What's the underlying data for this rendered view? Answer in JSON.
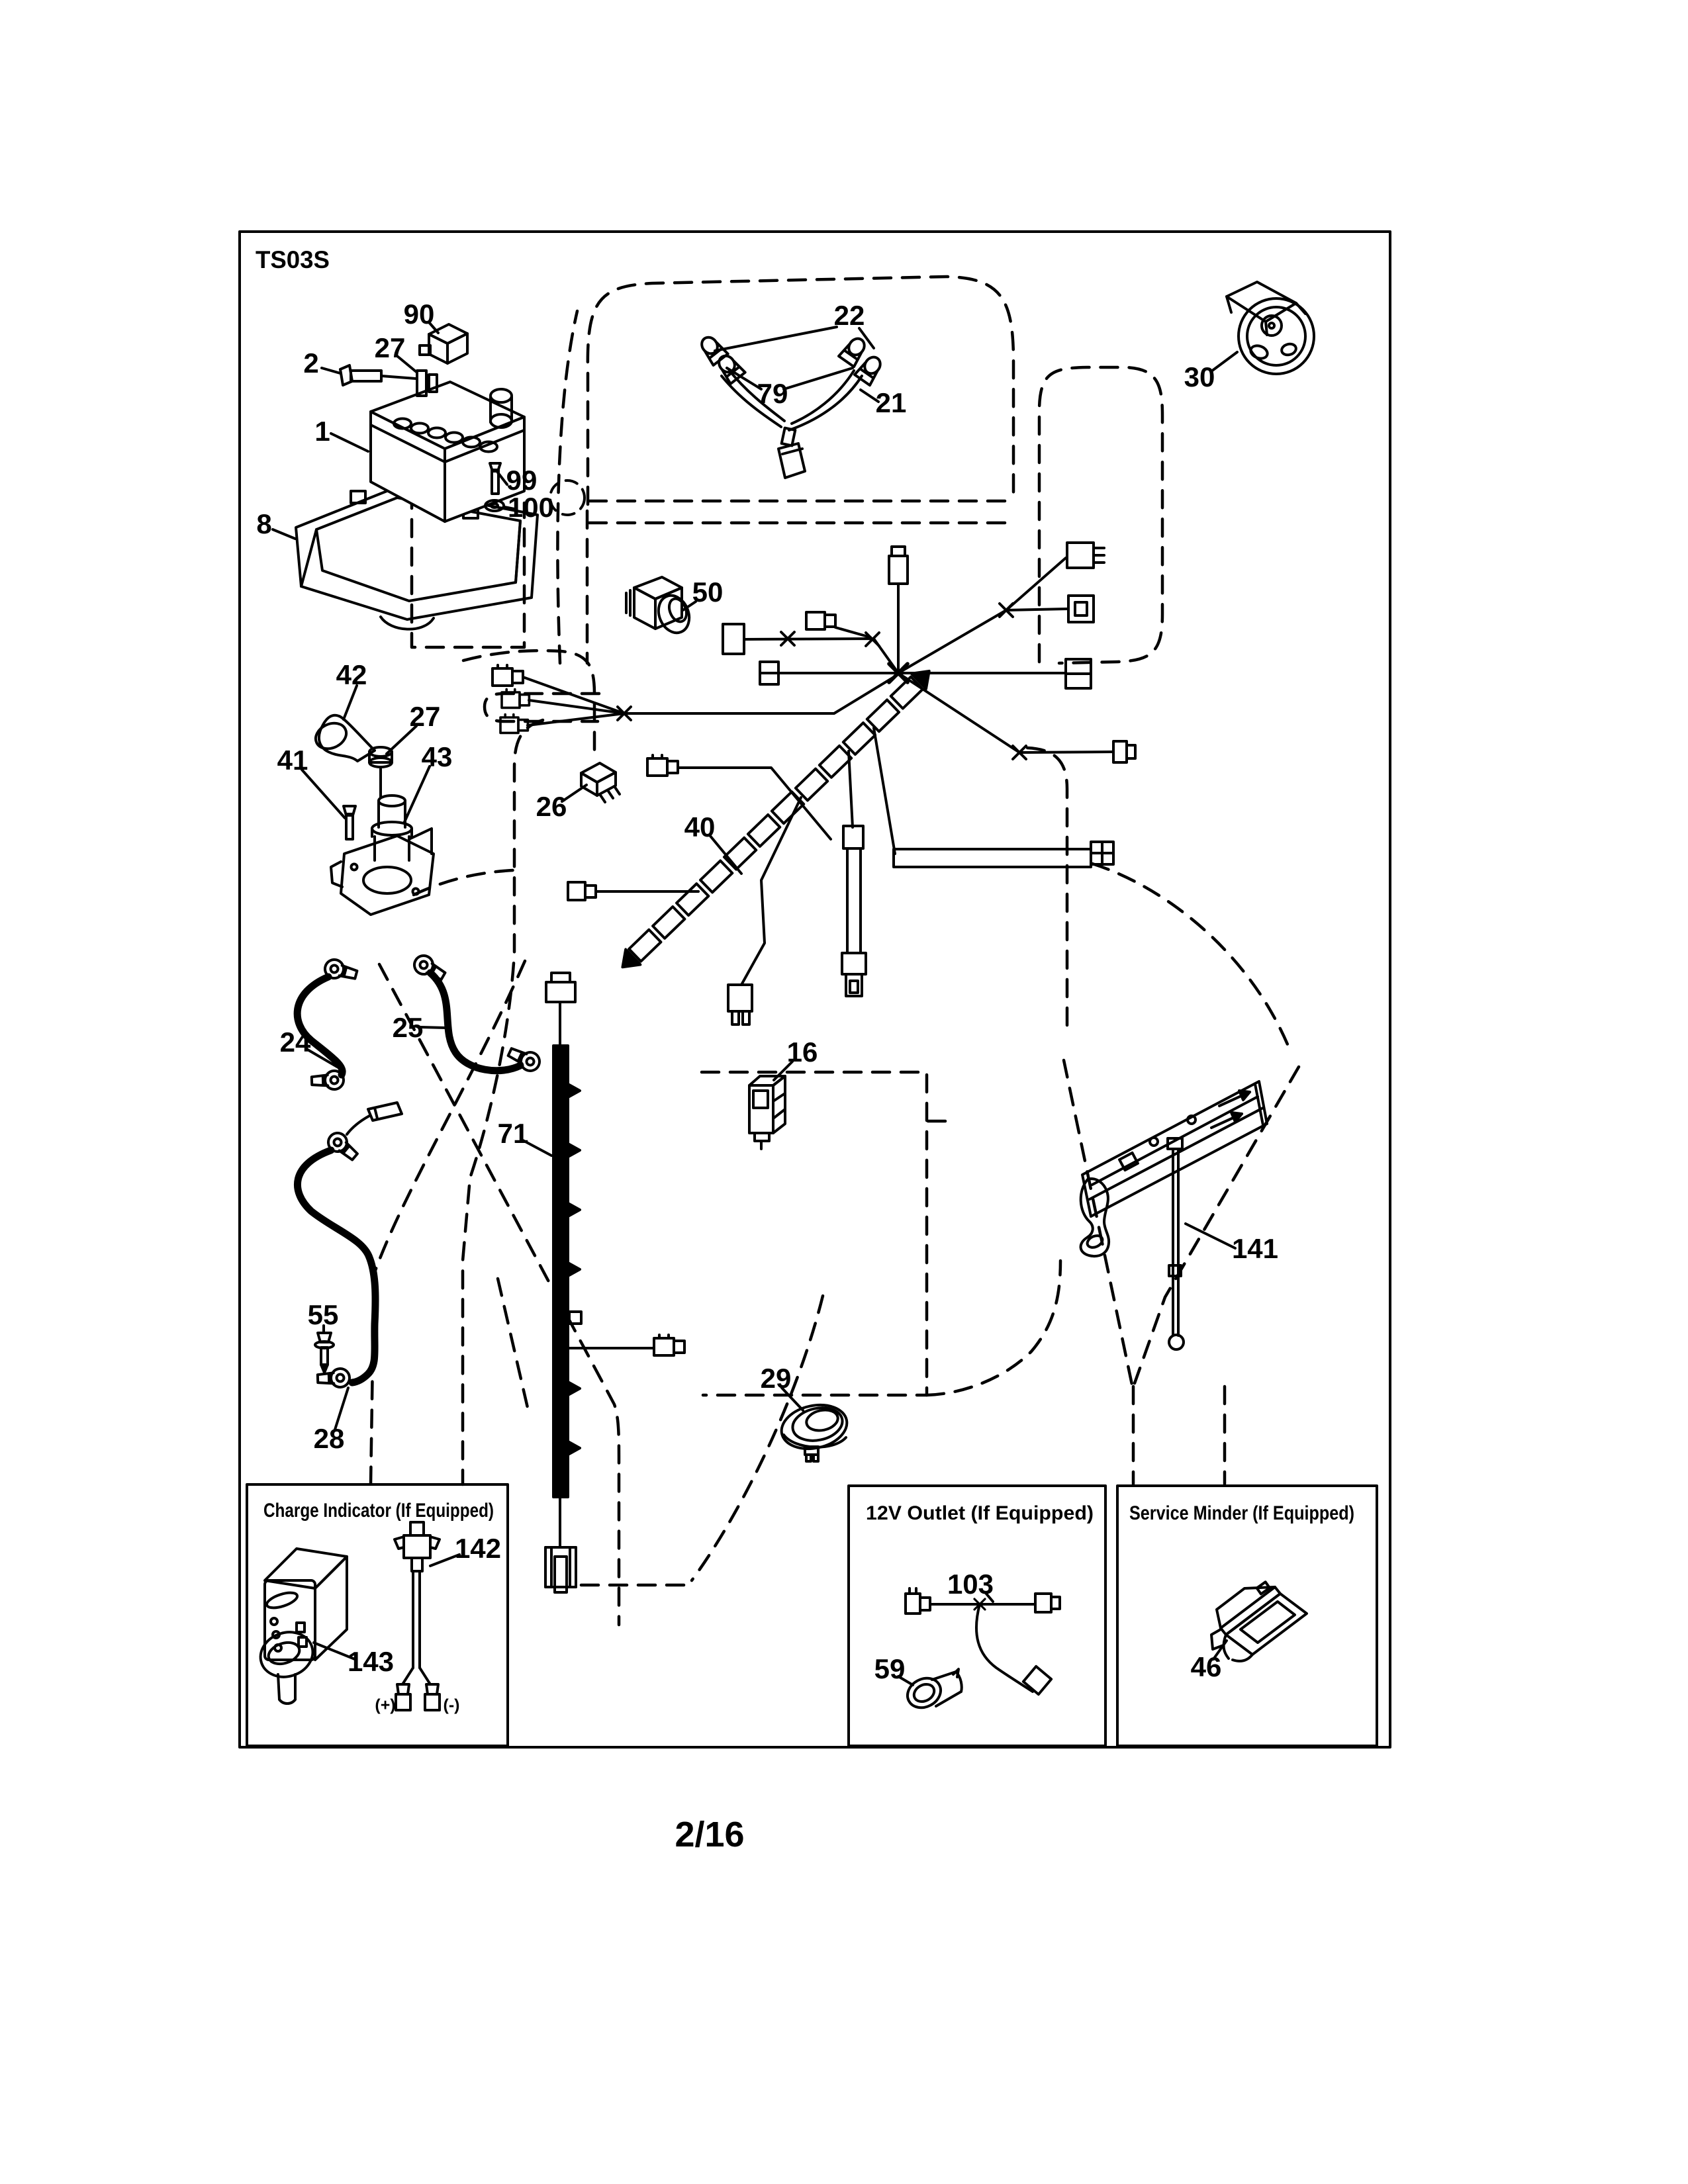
{
  "doc": {
    "sheet_code": "TS03S",
    "page_number": "2/16"
  },
  "callouts": {
    "battery": "1",
    "battery_bolt": "2",
    "battery_tray": "8",
    "interlock_switch": "16",
    "headlight_connector": "21",
    "headlight_bulbs": "22",
    "battery_cable_neg": "24",
    "battery_cable_pos": "25",
    "relay": "26",
    "battery_clamp_nut": "27",
    "solenoid_nut": "27",
    "ground_cable": "28",
    "horn": "29",
    "ignition_switch": "30",
    "main_harness": "40",
    "solenoid_bolt": "41",
    "terminal_boot": "42",
    "solenoid": "43",
    "plunger_switch": "50",
    "ground_bolt": "55",
    "wire_loom": "71",
    "headlight_harness": "79",
    "fuse_holder": "90",
    "hex_screw": "99",
    "washer": "100",
    "rod_bracket": "141"
  },
  "insets": {
    "charge_indicator": {
      "title": "Charge Indicator (If Equipped)",
      "wire": "142",
      "module": "143",
      "positive": "(+)",
      "negative": "(-)"
    },
    "outlet_12v": {
      "title": "12V Outlet (If Equipped)",
      "harness": "103",
      "socket": "59"
    },
    "service_minder": {
      "title": "Service Minder (If Equipped)",
      "display": "46"
    }
  },
  "colors": {
    "ink": "#000000",
    "paper": "#ffffff"
  }
}
